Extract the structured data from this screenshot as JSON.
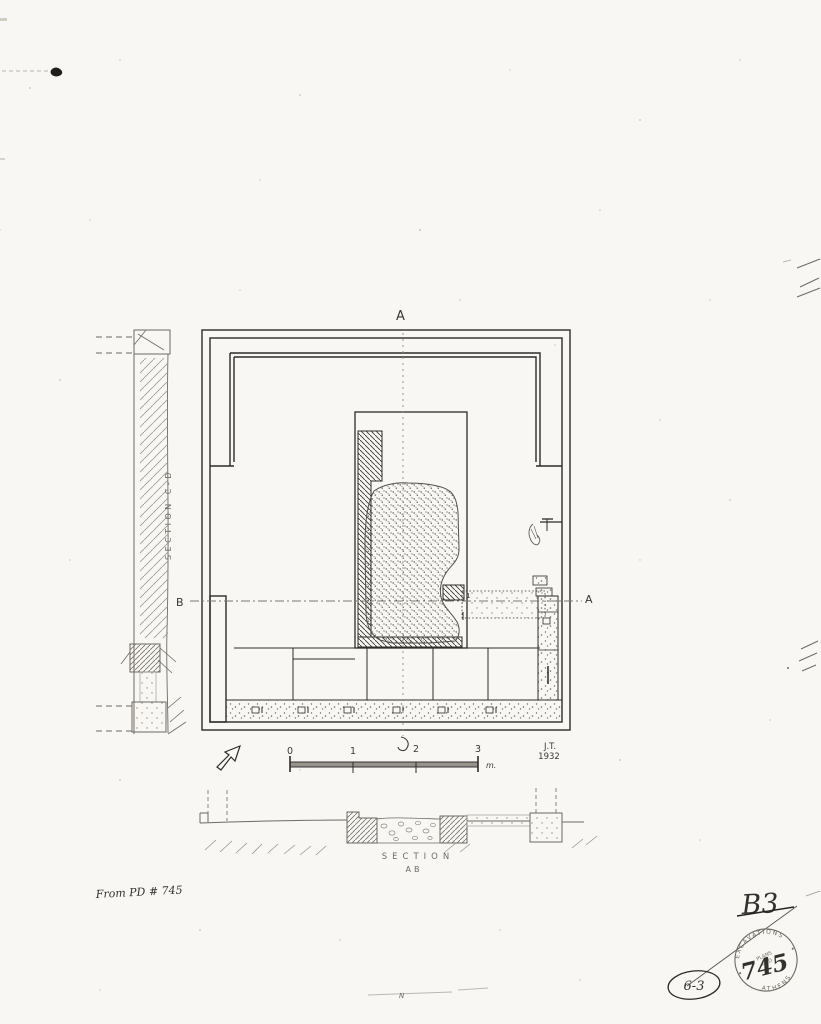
{
  "page": {
    "description": "Scanned archaeological plan and section drawing, pen and pencil on paper"
  },
  "plan": {
    "label_top": "A",
    "label_left": "B",
    "label_right": "A",
    "detail_mark": "1"
  },
  "left_section": {
    "title": "SECTION C-D"
  },
  "bottom_section": {
    "title": "SECTION",
    "subtitle": "AB"
  },
  "scale": {
    "ticks": {
      "t0": "0",
      "t1": "1",
      "t2": "2",
      "t3": "3"
    },
    "unit": "m.",
    "author_initials": "J.T.",
    "year": "1932"
  },
  "annotations": {
    "source_note": "From PD # 745",
    "page_code": "B3",
    "circled_code": "6-3",
    "stamp_number": "745",
    "n_mark": "N"
  },
  "stamp": {
    "arc_top": "EXCAVATIONS",
    "arc_bottom": "ATHENS",
    "center_line1": "PLANS",
    "center_line2": "AND"
  },
  "colors": {
    "paper": "#f8f7f3",
    "ink": "#2e2c28",
    "pencil": "#6e6a64"
  }
}
